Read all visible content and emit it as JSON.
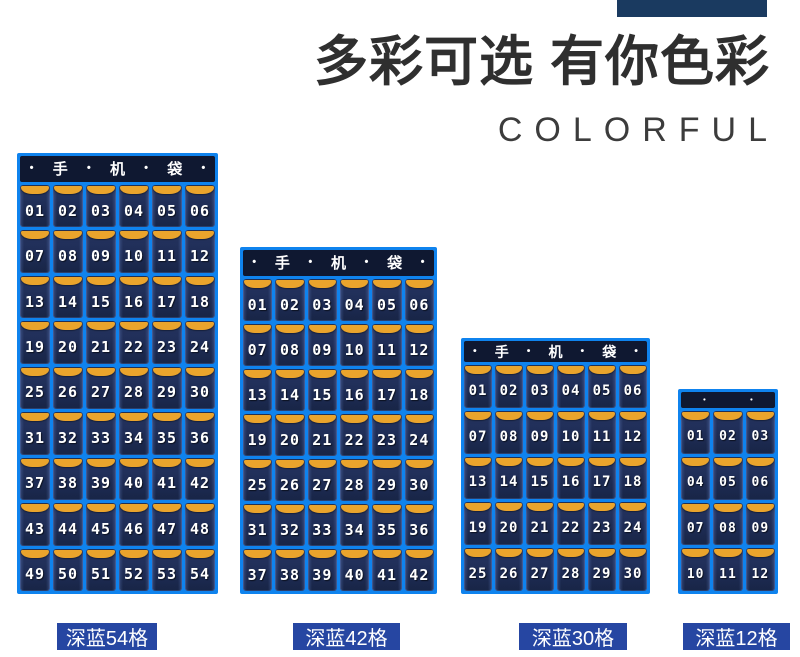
{
  "decor": {
    "top_bar_color": "#1a3a60",
    "grid_blue": "#0f83ee",
    "pocket_navy": "#1e2c55",
    "trim_orange": "#eaa42c",
    "header_navy": "#0f1831",
    "label_blue": "#2646a2"
  },
  "header": {
    "title": "多彩可选 有你色彩",
    "subtitle": "COLORFUL"
  },
  "organizers": [
    {
      "name": "深蓝54格",
      "columns": 6,
      "header_segments": [
        "•",
        "手",
        "•",
        "机",
        "•",
        "袋",
        "•"
      ],
      "pockets": [
        "01",
        "02",
        "03",
        "04",
        "05",
        "06",
        "07",
        "08",
        "09",
        "10",
        "11",
        "12",
        "13",
        "14",
        "15",
        "16",
        "17",
        "18",
        "19",
        "20",
        "21",
        "22",
        "23",
        "24",
        "25",
        "26",
        "27",
        "28",
        "29",
        "30",
        "31",
        "32",
        "33",
        "34",
        "35",
        "36",
        "37",
        "38",
        "39",
        "40",
        "41",
        "42",
        "43",
        "44",
        "45",
        "46",
        "47",
        "48",
        "49",
        "50",
        "51",
        "52",
        "53",
        "54"
      ]
    },
    {
      "name": "深蓝42格",
      "columns": 6,
      "header_segments": [
        "•",
        "手",
        "•",
        "机",
        "•",
        "袋",
        "•"
      ],
      "pockets": [
        "01",
        "02",
        "03",
        "04",
        "05",
        "06",
        "07",
        "08",
        "09",
        "10",
        "11",
        "12",
        "13",
        "14",
        "15",
        "16",
        "17",
        "18",
        "19",
        "20",
        "21",
        "22",
        "23",
        "24",
        "25",
        "26",
        "27",
        "28",
        "29",
        "30",
        "31",
        "32",
        "33",
        "34",
        "35",
        "36",
        "37",
        "38",
        "39",
        "40",
        "41",
        "42"
      ]
    },
    {
      "name": "深蓝30格",
      "columns": 6,
      "header_segments": [
        "•",
        "手",
        "•",
        "机",
        "•",
        "袋",
        "•"
      ],
      "pockets": [
        "01",
        "02",
        "03",
        "04",
        "05",
        "06",
        "07",
        "08",
        "09",
        "10",
        "11",
        "12",
        "13",
        "14",
        "15",
        "16",
        "17",
        "18",
        "19",
        "20",
        "21",
        "22",
        "23",
        "24",
        "25",
        "26",
        "27",
        "28",
        "29",
        "30"
      ]
    },
    {
      "name": "深蓝12格",
      "columns": 3,
      "header_segments": [
        "•",
        "•"
      ],
      "pockets": [
        "01",
        "02",
        "03",
        "04",
        "05",
        "06",
        "07",
        "08",
        "09",
        "10",
        "11",
        "12"
      ]
    }
  ]
}
